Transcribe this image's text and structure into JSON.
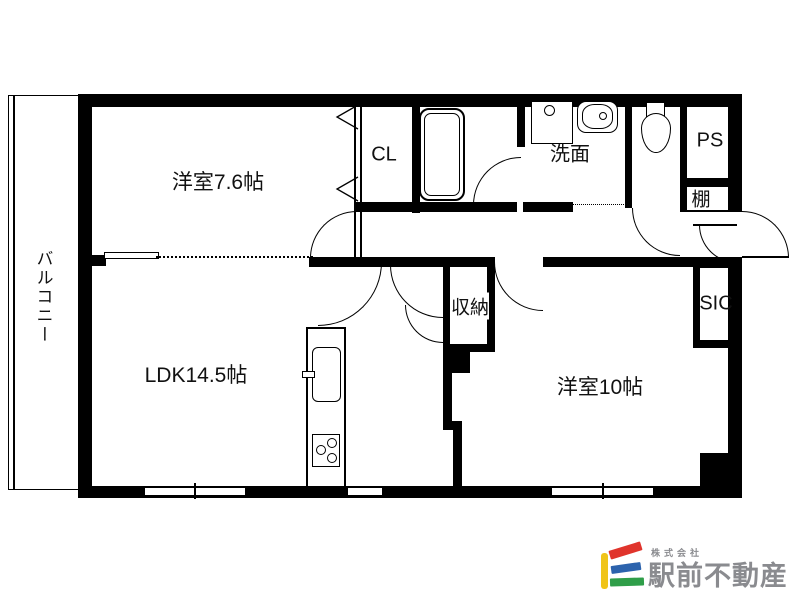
{
  "floorplan": {
    "labels": {
      "bedroom1": "洋室7.6帖",
      "closet": "CL",
      "washroom": "洗面",
      "pipe_space": "PS",
      "shelf": "棚",
      "balcony": "バルコニー",
      "ldk": "LDK14.5帖",
      "storage": "収納",
      "shoe_closet": "SIC",
      "bedroom2": "洋室10帖"
    },
    "fixtures": [
      {
        "name": "bathtub"
      },
      {
        "name": "washing-machine-pan"
      },
      {
        "name": "vanity-sink"
      },
      {
        "name": "toilet"
      },
      {
        "name": "kitchen-counter"
      },
      {
        "name": "kitchen-sink"
      },
      {
        "name": "gas-stove-3-burner"
      }
    ],
    "line_color": "#000000",
    "background_color": "#ffffff"
  },
  "logo": {
    "company_prefix": "株式会社",
    "company_name": "駅前不動産",
    "colors": {
      "yellow": "#f0c419",
      "red": "#e0342c",
      "blue": "#2c63ad",
      "green": "#2f9e49",
      "text": "#8a8b8f"
    }
  }
}
